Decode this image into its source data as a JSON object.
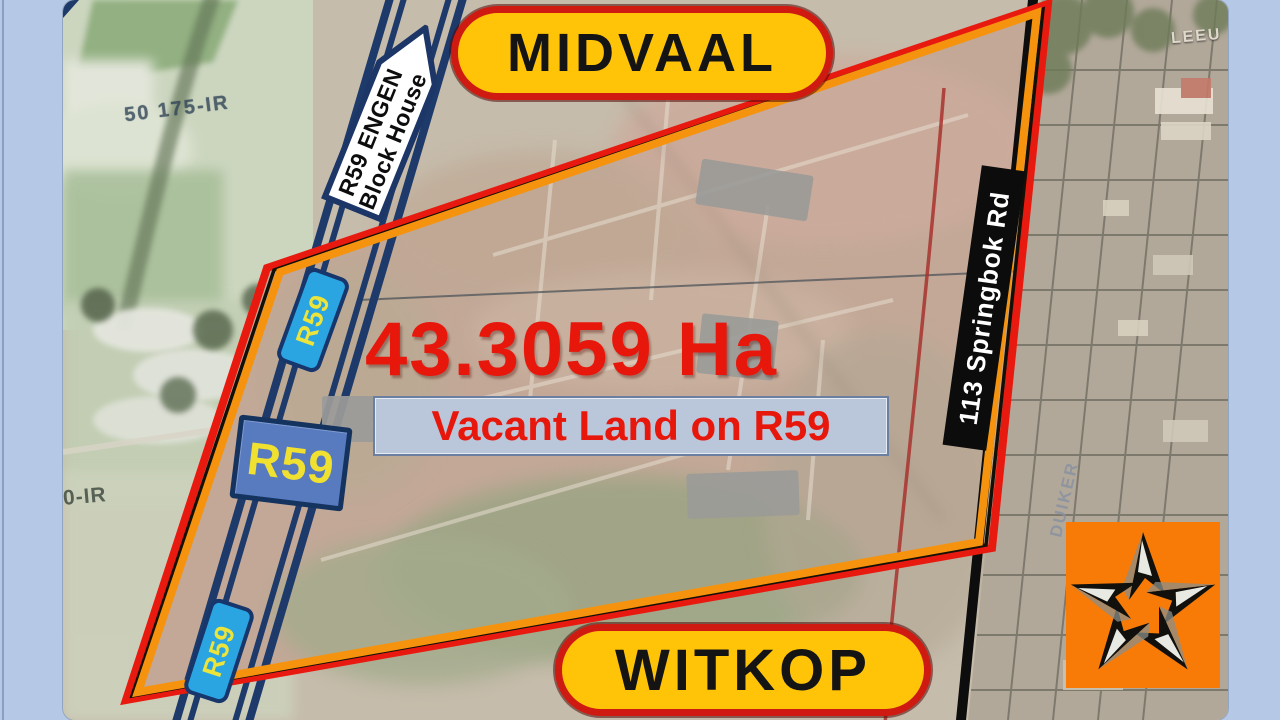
{
  "slide": {
    "region_top": "MIDVAAL",
    "region_bottom": "WITKOP",
    "area": "43.3059 Ha",
    "listing_title": "Vacant Land on R59",
    "colors": {
      "frame_blue": "#b5c8e6",
      "pill_yellow": "#ffc408",
      "pill_border_red": "#cf1a12",
      "headline_red": "#e8170c",
      "boundary_red": "#e81a10",
      "boundary_orange": "#f5930f",
      "road_navy": "#1d3a6a",
      "shield_blue": "#2ba5e2",
      "route_sign_blue": "#587bc0",
      "route_text_yellow": "#f0e030",
      "street_label_black": "#0c0c0c",
      "logo_orange": "#f87b07"
    },
    "icons": {
      "logo": "star-icon"
    }
  },
  "map": {
    "signs": {
      "engen_line1": "R59 ENGEN",
      "engen_line2": "Block House",
      "shield_top": "R59",
      "shield_bottom": "R59",
      "route_sign": "R59",
      "street": "113 Springbok Rd"
    },
    "labels": {
      "parcel_upper": "50 175-IR",
      "parcel_lower": "0-IR",
      "street_leeu": "LEEU",
      "street_duiker": "DUIKER"
    }
  }
}
